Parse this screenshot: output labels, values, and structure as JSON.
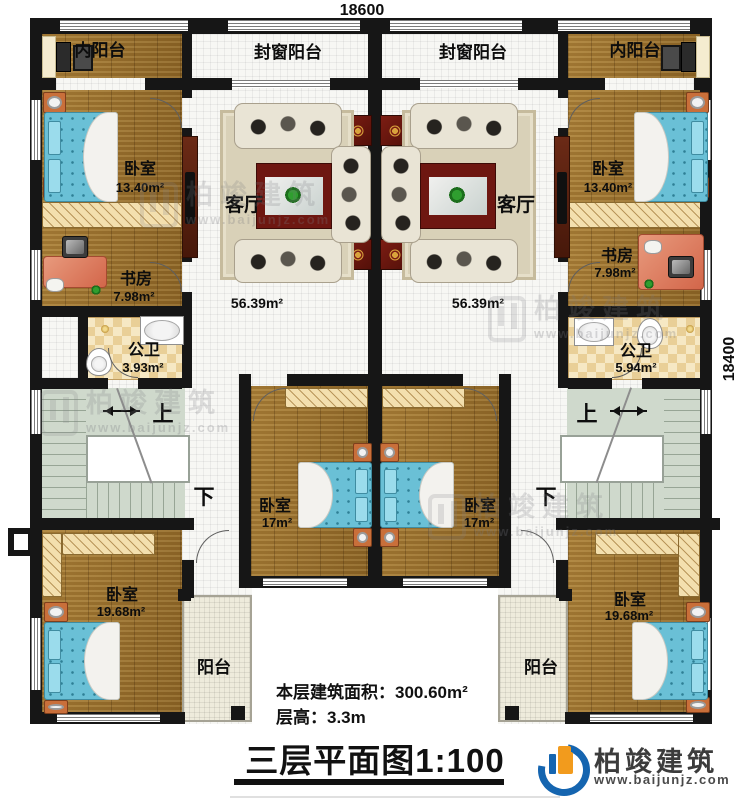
{
  "dimensions": {
    "width_label": "18600",
    "height_label": "18400"
  },
  "unit_left": {
    "inner_balcony_label": "内阳台",
    "enclosed_balcony_label": "封窗阳台",
    "bedroom_top": {
      "name": "卧室",
      "area": "13.40m²"
    },
    "living": {
      "name": "客厅",
      "area": "56.39m²"
    },
    "study": {
      "name": "书房",
      "area": "7.98m²"
    },
    "bathroom": {
      "name": "公卫",
      "area": "3.93m²"
    },
    "stair": {
      "up": "上",
      "down": "下"
    },
    "bedroom_mid": {
      "name": "卧室",
      "area": "17m²"
    },
    "bedroom_bottom": {
      "name": "卧室",
      "area": "19.68m²"
    },
    "balcony_label": "阳台"
  },
  "unit_right": {
    "inner_balcony_label": "内阳台",
    "enclosed_balcony_label": "封窗阳台",
    "bedroom_top": {
      "name": "卧室",
      "area": "13.40m²"
    },
    "living": {
      "name": "客厅",
      "area": "56.39m²"
    },
    "study": {
      "name": "书房",
      "area": "7.98m²"
    },
    "bathroom": {
      "name": "公卫",
      "area": "5.94m²"
    },
    "stair": {
      "up": "上",
      "down": "下"
    },
    "bedroom_mid": {
      "name": "卧室",
      "area": "17m²"
    },
    "bedroom_bottom": {
      "name": "卧室",
      "area": "19.68m²"
    },
    "balcony_label": "阳台"
  },
  "summary": {
    "building_area": "本层建筑面积：300.60m²",
    "floor_height": "层高：3.3m"
  },
  "title": "三层平面图1:100",
  "brand": {
    "name": "柏竣建筑",
    "website": "www.baijunjz.com"
  },
  "watermark": {
    "name": "柏竣建筑",
    "website": "www.baijunjz.com"
  },
  "colors": {
    "wall": "#161616",
    "wood_floor": "#9b7230",
    "bath_tile": "#e9cf97",
    "stair": "#cfd9cc",
    "accent_red": "#6e1711",
    "bed_blue": "#6ac0d6",
    "brand_blue": "#1565b0",
    "brand_orange": "#f29b1d"
  }
}
